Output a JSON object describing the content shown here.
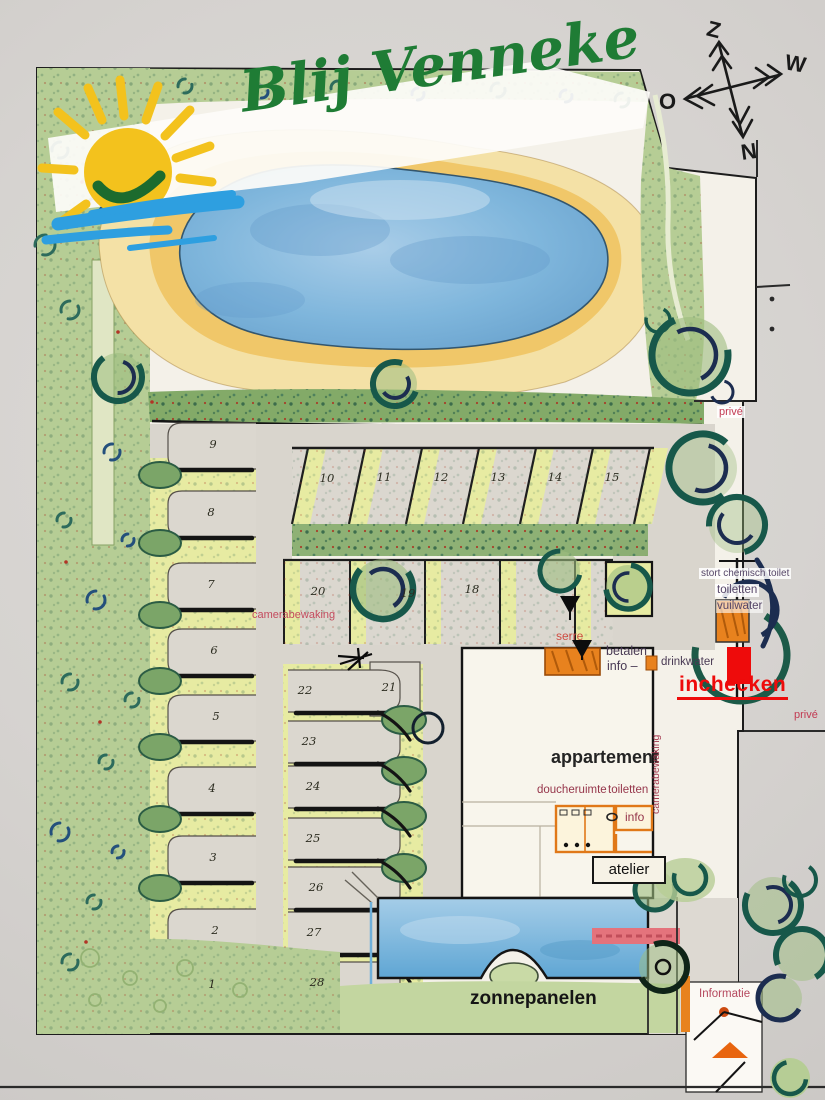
{
  "title": "Blij Venneke",
  "compass": {
    "top": "Z",
    "right": "W",
    "left": "O",
    "bottom": "N"
  },
  "labels": {
    "prive_top": "privé",
    "prive_bottom": "privé",
    "stort": "stort chemisch toilet",
    "toiletten_right": "toiletten",
    "vuilwater": "vuilwater",
    "inchecken": "inchecken",
    "serre": "serre",
    "betalen": "betalen",
    "info_dash": "info –",
    "drinkwater": "drinkwater",
    "appartement": "appartement",
    "doucheruimte": "doucheruimte",
    "toiletten_building": "toiletten",
    "info_building": "info",
    "camerabewaking_left": "camerabewaking",
    "camerabewaking_right": "camerabewaking",
    "atelier": "atelier",
    "zonnepanelen": "zonnepanelen",
    "informatie": "Informatie"
  },
  "pitches": {
    "n1": "1",
    "n2": "2",
    "n3": "3",
    "n4": "4",
    "n5": "5",
    "n6": "6",
    "n7": "7",
    "n8": "8",
    "n9": "9",
    "n10": "10",
    "n11": "11",
    "n12": "12",
    "n13": "13",
    "n14": "14",
    "n15": "15",
    "n18": "18",
    "n19": "19",
    "n20": "20",
    "n21": "21",
    "n22": "22",
    "n23": "23",
    "n24": "24",
    "n25": "25",
    "n26": "26",
    "n27": "27",
    "n28": "28"
  },
  "colors": {
    "brand_green": "#1f7c35",
    "sun_yellow": "#f3c21d",
    "wave_blue": "#2e9fe0",
    "accent_orange": "#e8821e",
    "alert_red": "#ee0b0b",
    "label_red": "#b5485e",
    "pond_blue": "#7fb6dc",
    "sand": "#efc463"
  }
}
